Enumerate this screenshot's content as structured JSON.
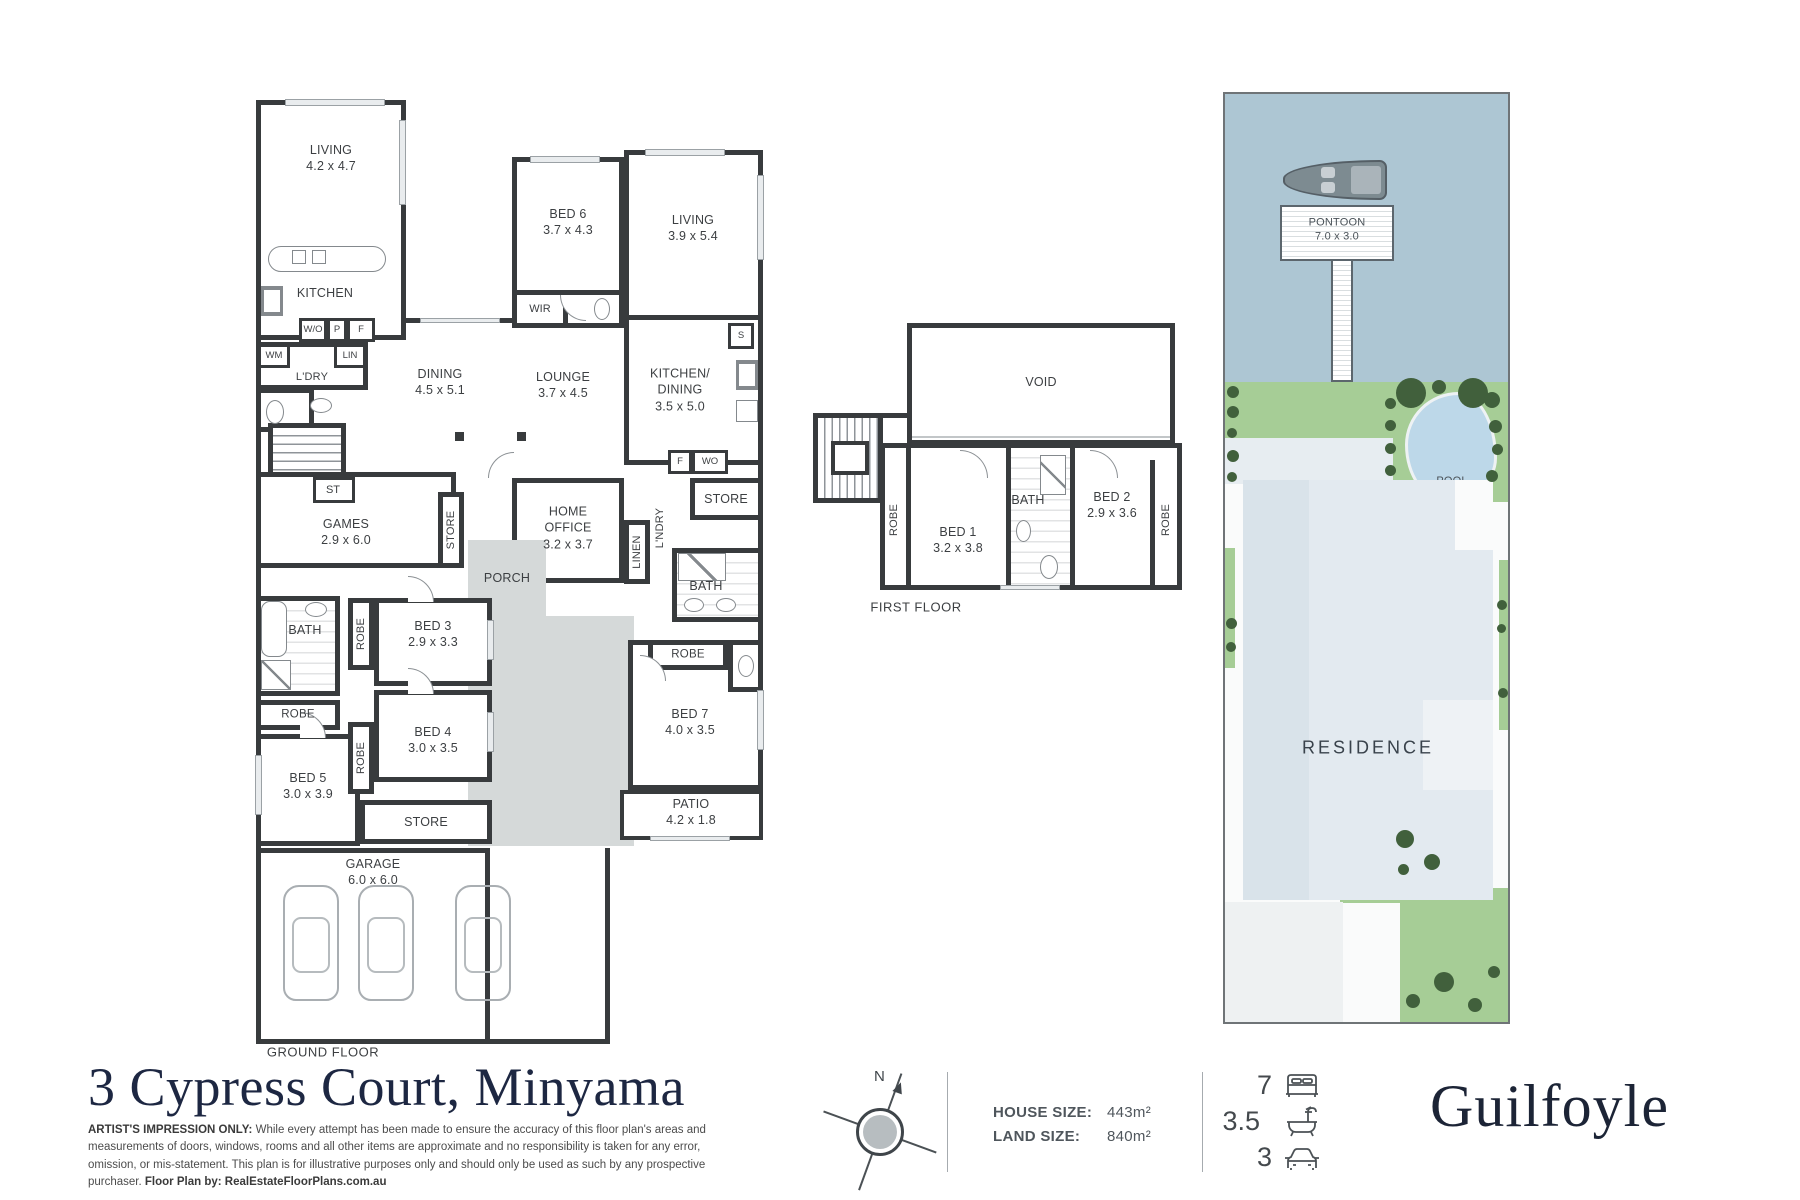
{
  "address": "3 Cypress Court, Minyama",
  "brand": "Guilfoyle",
  "disclaimer": {
    "bold_prefix": "ARTIST'S IMPRESSION ONLY:",
    "body": " While every attempt has been made to ensure the accuracy of this floor plan's areas and measurements of doors, windows, rooms and all other items are approximate and no responsibility is taken for any error, omission, or mis-statement. This plan is for illustrative purposes only and should only be used as such by any prospective purchaser. ",
    "bold_suffix": "Floor Plan by: RealEstateFloorPlans.com.au"
  },
  "compass": {
    "north_label": "N"
  },
  "metrics": {
    "house_size_label": "HOUSE SIZE:",
    "house_size_value": "443m²",
    "land_size_label": "LAND SIZE:",
    "land_size_value": "840m²"
  },
  "stats": {
    "beds": "7",
    "baths": "3.5",
    "cars": "3"
  },
  "ground_floor": {
    "caption": "GROUND FLOOR",
    "rooms": {
      "living1": {
        "name": "LIVING",
        "dims": "4.2 x 4.7"
      },
      "kitchen": {
        "name": "KITCHEN"
      },
      "ldry": {
        "name": "L'DRY"
      },
      "dining": {
        "name": "DINING",
        "dims": "4.5 x 5.1"
      },
      "lounge": {
        "name": "LOUNGE",
        "dims": "3.7 x 4.5"
      },
      "bed6": {
        "name": "BED 6",
        "dims": "3.7 x 4.3"
      },
      "wir": {
        "name": "WIR"
      },
      "living2": {
        "name": "LIVING",
        "dims": "3.9 x 5.4"
      },
      "kitchen_dining": {
        "name": "KITCHEN/\nDINING",
        "dims": "3.5 x 5.0"
      },
      "store_top": {
        "name": "STORE"
      },
      "home_office": {
        "name": "HOME\nOFFICE",
        "dims": "3.2 x 3.7"
      },
      "linen": {
        "name": "LINEN"
      },
      "lndry2": {
        "name": "L'NDRY"
      },
      "bath_mid": {
        "name": "BATH"
      },
      "st": {
        "name": "ST"
      },
      "games": {
        "name": "GAMES",
        "dims": "2.9 x 6.0"
      },
      "store_games": {
        "name": "STORE"
      },
      "porch": {
        "name": "PORCH"
      },
      "bath_left": {
        "name": "BATH"
      },
      "robe_left": {
        "name": "ROBE"
      },
      "bed3": {
        "name": "BED 3",
        "dims": "2.9 x 3.3"
      },
      "robe3": {
        "name": "ROBE"
      },
      "bed4": {
        "name": "BED 4",
        "dims": "3.0 x 3.5"
      },
      "robe4": {
        "name": "ROBE"
      },
      "bed5": {
        "name": "BED 5",
        "dims": "3.0 x 3.9"
      },
      "store_bottom": {
        "name": "STORE"
      },
      "garage": {
        "name": "GARAGE",
        "dims": "6.0 x 6.0"
      },
      "robe7": {
        "name": "ROBE"
      },
      "bed7": {
        "name": "BED 7",
        "dims": "4.0 x 3.5"
      },
      "patio": {
        "name": "PATIO",
        "dims": "4.2 x 1.8"
      }
    },
    "small": {
      "wo": "W/O",
      "p": "P",
      "f": "F",
      "wm": "WM",
      "lin": "LIN",
      "s": "S",
      "f2": "F",
      "wo2": "WO"
    }
  },
  "first_floor": {
    "caption": "FIRST FLOOR",
    "rooms": {
      "void": {
        "name": "VOID"
      },
      "bed1": {
        "name": "BED 1",
        "dims": "3.2 x 3.8"
      },
      "robe1": {
        "name": "ROBE"
      },
      "bath": {
        "name": "BATH"
      },
      "bed2": {
        "name": "BED 2",
        "dims": "2.9 x 3.6"
      },
      "robe2": {
        "name": "ROBE"
      }
    }
  },
  "site_plan": {
    "pontoon": {
      "name": "PONTOON",
      "dims": "7.0 x 3.0"
    },
    "pool": {
      "name": "POOL"
    },
    "residence": {
      "name": "RESIDENCE"
    }
  },
  "colors": {
    "wall": "#383b3d",
    "water": "#adc6d3",
    "lawn": "#a6cd96",
    "tree": "#41603c",
    "pool": "#bdd8e9",
    "residence_fill": "#e3eaf0",
    "driveway": "#d5d9d9",
    "navy": "#1d2742"
  }
}
